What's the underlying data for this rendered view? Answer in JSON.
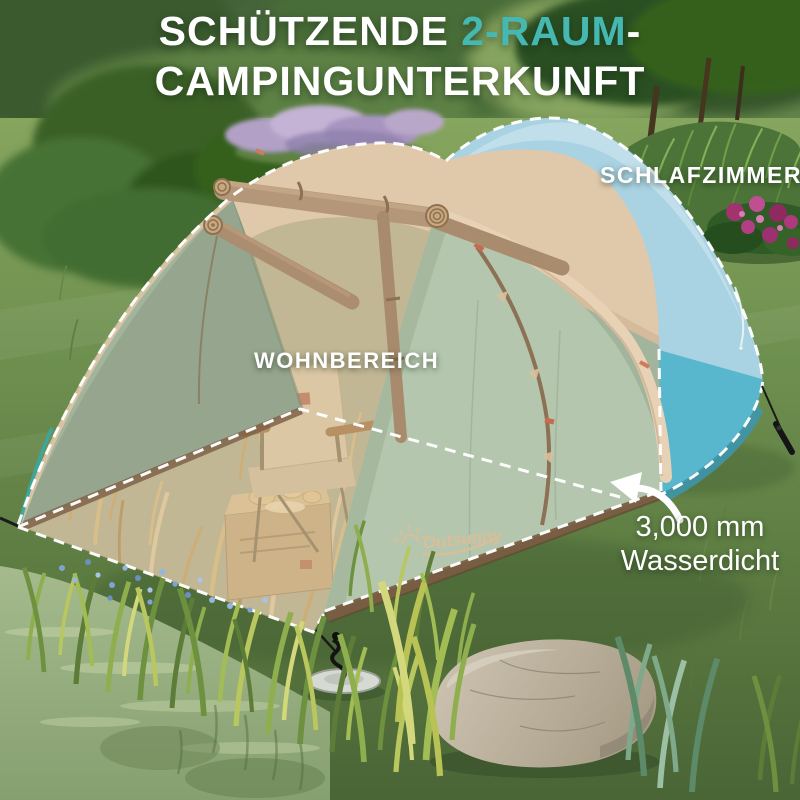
{
  "headline": {
    "part1": "SCHÜTZENDE ",
    "accent": "2-RAUM",
    "part2": "-",
    "line2": "CAMPINGUNTERKUNFT",
    "accent_color": "#45b8b2"
  },
  "labels": {
    "bedroom": "SCHLAFZIMMER",
    "living": "WOHNBEREICH"
  },
  "callout": {
    "line1": "3,000 mm",
    "line2": "Wasserdicht"
  },
  "brand": {
    "logo_text": "Outsunny",
    "logo_icon": "sun-rays-icon"
  },
  "scene": {
    "description": "Tunnelzelt auf einer Wiese: transparent dargestellter Wohnbereich mit Campingstuhl und Kiste, blau hervorgehobenes Schlafzimmer, Pfeil auf wasserdichten Boden",
    "colors": {
      "accent_teal": "#45b8b2",
      "tent_beige": "#e0c9ab",
      "tent_mint": "#b4c6ad",
      "tent_sage": "#93a28b",
      "bedroom_blue": "#a9d2e2",
      "bedroom_teal": "#58b7cd",
      "skirt_brown": "#7b5c43",
      "grass_green": "#6f9150",
      "label_white": "#ffffff"
    }
  }
}
